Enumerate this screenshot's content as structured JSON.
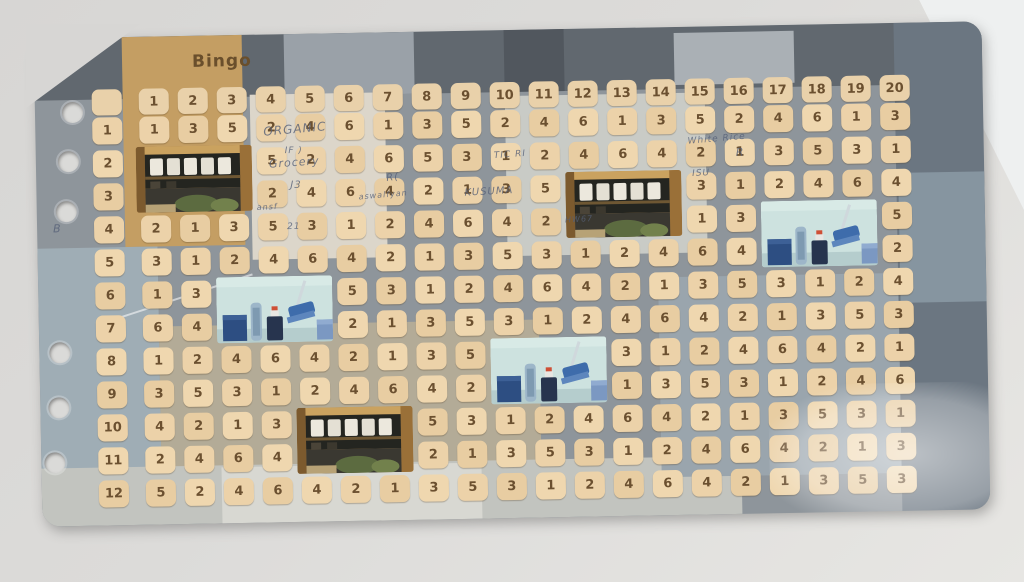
{
  "title": "Bingo",
  "board": {
    "column_headers": [
      "1",
      "2",
      "3",
      "4",
      "5",
      "6",
      "7",
      "8",
      "9",
      "10",
      "11",
      "12",
      "13",
      "14",
      "15",
      "16",
      "17",
      "18",
      "19",
      "20"
    ],
    "row_labels": [
      "1",
      "2",
      "3",
      "4",
      "5",
      "6",
      "7",
      "8",
      "9",
      "10",
      "11",
      "12"
    ],
    "rows": [
      [
        "1",
        "3",
        "5",
        "2",
        "4",
        "6",
        "1",
        "3",
        "5",
        "2",
        "4",
        "6",
        "1",
        "3",
        "5",
        "2",
        "4",
        "6",
        "1",
        "3"
      ],
      [
        "",
        "",
        "",
        "5",
        "2",
        "4",
        "6",
        "5",
        "3",
        "1",
        "2",
        "4",
        "6",
        "4",
        "2",
        "1",
        "3",
        "5",
        "3",
        "1"
      ],
      [
        "",
        "",
        "",
        "2",
        "4",
        "6",
        "4",
        "2",
        "1",
        "3",
        "5",
        "",
        "",
        "",
        "3",
        "1",
        "2",
        "4",
        "6",
        "4"
      ],
      [
        "2",
        "1",
        "3",
        "5",
        "3",
        "1",
        "2",
        "4",
        "6",
        "4",
        "2",
        "",
        "",
        "",
        "1",
        "3",
        "",
        "",
        "",
        "5"
      ],
      [
        "3",
        "1",
        "2",
        "4",
        "6",
        "4",
        "2",
        "1",
        "3",
        "5",
        "3",
        "1",
        "2",
        "4",
        "6",
        "4",
        "",
        "",
        "",
        "2"
      ],
      [
        "1",
        "3",
        "",
        "",
        "",
        "5",
        "3",
        "1",
        "2",
        "4",
        "6",
        "4",
        "2",
        "1",
        "3",
        "5",
        "3",
        "1",
        "2",
        "4"
      ],
      [
        "6",
        "4",
        "",
        "",
        "",
        "2",
        "1",
        "3",
        "5",
        "3",
        "1",
        "2",
        "4",
        "6",
        "4",
        "2",
        "1",
        "3",
        "5",
        "3"
      ],
      [
        "1",
        "2",
        "4",
        "6",
        "4",
        "2",
        "1",
        "3",
        "5",
        "",
        "",
        "",
        "3",
        "1",
        "2",
        "4",
        "6",
        "4",
        "2",
        "1"
      ],
      [
        "3",
        "5",
        "3",
        "1",
        "2",
        "4",
        "6",
        "4",
        "2",
        "",
        "",
        "",
        "1",
        "3",
        "5",
        "3",
        "1",
        "2",
        "4",
        "6"
      ],
      [
        "4",
        "2",
        "1",
        "3",
        "",
        "",
        "",
        "5",
        "3",
        "1",
        "2",
        "4",
        "6",
        "4",
        "2",
        "1",
        "3",
        "5",
        "3",
        "1"
      ],
      [
        "2",
        "4",
        "6",
        "4",
        "",
        "",
        "",
        "2",
        "1",
        "3",
        "5",
        "3",
        "1",
        "2",
        "4",
        "6",
        "4",
        "2",
        "1",
        "3"
      ],
      [
        "5",
        "2",
        "4",
        "6",
        "4",
        "2",
        "1",
        "3",
        "5",
        "3",
        "1",
        "2",
        "4",
        "6",
        "4",
        "2",
        "1",
        "3",
        "5",
        "3"
      ]
    ],
    "photo_patches": [
      {
        "name": "shop-shelf-photo-1",
        "kind": "shop",
        "r1": 2,
        "r2": 3,
        "c1": 1,
        "c2": 3
      },
      {
        "name": "shop-shelf-photo-2",
        "kind": "shop",
        "r1": 3,
        "r2": 4,
        "c1": 12,
        "c2": 14
      },
      {
        "name": "shop-shelf-photo-3",
        "kind": "shop",
        "r1": 10,
        "r2": 11,
        "c1": 5,
        "c2": 7
      },
      {
        "name": "blue-room-photo-1",
        "kind": "blue",
        "r1": 4,
        "r2": 5,
        "c1": 17,
        "c2": 19
      },
      {
        "name": "blue-room-photo-2",
        "kind": "blue",
        "r1": 6,
        "r2": 7,
        "c1": 3,
        "c2": 5
      },
      {
        "name": "blue-room-photo-3",
        "kind": "blue",
        "r1": 8,
        "r2": 9,
        "c1": 10,
        "c2": 12
      }
    ],
    "handwriting": [
      {
        "text": "ORGANIC",
        "x": 228,
        "y": 88,
        "size": 12,
        "rot": -4
      },
      {
        "text": "Grocery",
        "x": 233,
        "y": 122,
        "size": 11,
        "rot": -3
      },
      {
        "text": "IF )",
        "x": 249,
        "y": 112,
        "size": 9,
        "rot": 0
      },
      {
        "text": "J3",
        "x": 254,
        "y": 146,
        "size": 10,
        "rot": 2
      },
      {
        "text": "ansf",
        "x": 220,
        "y": 168,
        "size": 8,
        "rot": -2
      },
      {
        "text": "21",
        "x": 250,
        "y": 188,
        "size": 9,
        "rot": 0
      },
      {
        "text": "R(",
        "x": 350,
        "y": 140,
        "size": 10,
        "rot": -6
      },
      {
        "text": "aswalfyan",
        "x": 322,
        "y": 158,
        "size": 8,
        "rot": -4
      },
      {
        "text": "TIC RI",
        "x": 458,
        "y": 120,
        "size": 9,
        "rot": -3
      },
      {
        "text": "KUSUMA",
        "x": 428,
        "y": 156,
        "size": 10,
        "rot": -2
      },
      {
        "text": "HW67",
        "x": 528,
        "y": 186,
        "size": 8,
        "rot": -2
      },
      {
        "text": "White Rice",
        "x": 652,
        "y": 108,
        "size": 9,
        "rot": -4
      },
      {
        "text": "R",
        "x": 700,
        "y": 120,
        "size": 11,
        "rot": 0
      },
      {
        "text": "ISU",
        "x": 656,
        "y": 142,
        "size": 9,
        "rot": -2
      },
      {
        "text": "B",
        "x": 16,
        "y": 184,
        "size": 11,
        "rot": 0
      }
    ]
  },
  "colors": {
    "tile": "#ecd2a9",
    "tile_text": "#6b5030",
    "desk": "#dcdbd9",
    "board_edge": "#61686f",
    "photo_blue_bg": "#cde2df",
    "photo_shop_bg": "#b08449"
  }
}
